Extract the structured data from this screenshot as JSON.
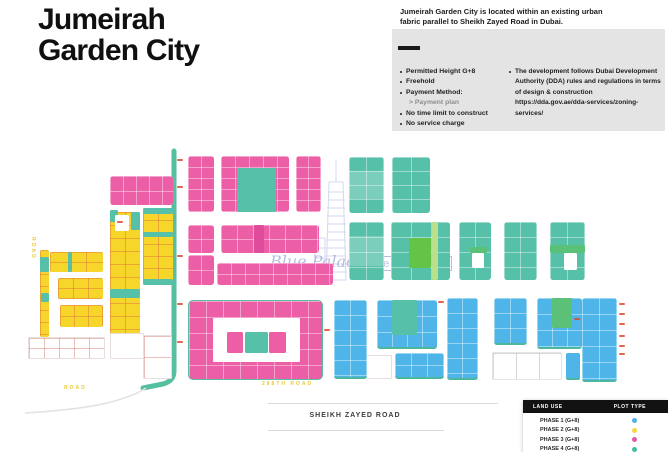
{
  "header": {
    "title_line1": "Jumeirah",
    "title_line2": "Garden City",
    "intro": "Jumeirah Garden City is located within an existing urban fabric parallel to Sheikh Zayed Road in Dubai."
  },
  "info_box": {
    "left_bullets": [
      {
        "text": "Permitted Height G+8"
      },
      {
        "text": "Freehold"
      },
      {
        "text": "Payment Method:"
      },
      {
        "text": "> Payment plan"
      },
      {
        "text": "No time limit to construct"
      },
      {
        "text": "No service charge"
      }
    ],
    "right_lines": [
      "The development follows Dubai Development",
      "Authority (DDA) rules and regulations in terms",
      "of design & construction",
      "https://dda.gov.ae/dda-services/zoning-services/"
    ]
  },
  "road": {
    "label": "SHEIKH ZAYED ROAD"
  },
  "watermark": {
    "script": "Blue Palace",
    "boxed": "Real Estate"
  },
  "legend": {
    "header_left": "LAND USE",
    "header_right": "PLOT TYPE",
    "rows": [
      {
        "label": "PHASE 1 (G+8)",
        "dot": "#4FB0E8",
        "dot_style": "background:#4FB0E8"
      },
      {
        "label": "PHASE 2 (G+8)",
        "dot": "#F7D643",
        "dot_style": "background:#F7D643"
      },
      {
        "label": "PHASE 3 (G+8)",
        "dot": "#DE5BA7",
        "dot_style": "background:#DE5BA7"
      },
      {
        "label": "PHASE 4 (G+8)",
        "dot": "#3FBF9F",
        "dot_style": "background:#3FBF9F"
      }
    ]
  },
  "colors": {
    "phase1": "#4FB5E9",
    "phase2": "#F7D62B",
    "phase3": "#EC5FA6",
    "phase4": "#57C0A9",
    "green": "#64C447",
    "green2": "#5BC178",
    "lightgreen": "#B9E08A",
    "white": "#FFFFFF",
    "road_teal": "#55BFA0",
    "tick_red": "#E0492E",
    "watermark": "#A9B2DC"
  },
  "map": {
    "blocks": [
      {
        "x": 110,
        "y": 176,
        "w": 63,
        "h": 29,
        "c": "phase3",
        "cs": [
          13,
          15
        ],
        "r": 3
      },
      {
        "x": 188,
        "y": 156,
        "w": 26,
        "h": 56,
        "c": "phase3",
        "cs": [
          13,
          11
        ],
        "r": 3
      },
      {
        "x": 221,
        "y": 156,
        "w": 68,
        "h": 56,
        "c": "phase3",
        "cs": [
          14,
          11
        ],
        "r": 3
      },
      {
        "x": 237,
        "y": 168,
        "w": 39,
        "h": 44,
        "c": "phase4",
        "r": 2
      },
      {
        "x": 296,
        "y": 156,
        "w": 25,
        "h": 56,
        "c": "phase3",
        "cs": [
          12,
          11
        ],
        "r": 3
      },
      {
        "x": 188,
        "y": 225,
        "w": 26,
        "h": 28,
        "c": "phase3",
        "cs": [
          13,
          14
        ],
        "r": 3
      },
      {
        "x": 221,
        "y": 225,
        "w": 98,
        "h": 28,
        "c": "phase3",
        "cs": [
          16,
          14
        ],
        "r": 3
      },
      {
        "x": 254,
        "y": 225,
        "w": 10,
        "h": 28,
        "c": "#E04C9C"
      },
      {
        "x": 188,
        "y": 255,
        "w": 26,
        "h": 30,
        "c": "phase3",
        "cs": [
          13,
          15
        ],
        "r": 3
      },
      {
        "x": 217,
        "y": 263,
        "w": 116,
        "h": 22,
        "c": "phase3",
        "cs": [
          14,
          11
        ],
        "r": 3
      },
      {
        "x": 188,
        "y": 300,
        "w": 133,
        "h": 78,
        "c": "phase3",
        "cs": [
          17,
          16
        ],
        "bd": "1.5px solid #55BFA0",
        "r": 5
      },
      {
        "x": 213,
        "y": 318,
        "w": 87,
        "h": 44,
        "c": "white"
      },
      {
        "x": 227,
        "y": 332,
        "w": 16,
        "h": 21,
        "c": "phase3"
      },
      {
        "x": 245,
        "y": 332,
        "w": 23,
        "h": 21,
        "c": "phase4"
      },
      {
        "x": 269,
        "y": 332,
        "w": 17,
        "h": 21,
        "c": "phase3"
      },
      {
        "x": 40,
        "y": 250,
        "w": 9,
        "h": 87,
        "c": "phase2",
        "cs": [
          9,
          12
        ],
        "r": 2
      },
      {
        "x": 40,
        "y": 257,
        "w": 9,
        "h": 15,
        "c": "phase4"
      },
      {
        "x": 41,
        "y": 293,
        "w": 8,
        "h": 9,
        "c": "phase4"
      },
      {
        "x": 50,
        "y": 252,
        "w": 53,
        "h": 20,
        "c": "phase2",
        "cs": [
          18,
          10
        ],
        "r": 2
      },
      {
        "x": 68,
        "y": 252,
        "w": 4,
        "h": 20,
        "c": "phase4"
      },
      {
        "x": 58,
        "y": 278,
        "w": 45,
        "h": 21,
        "c": "phase2",
        "cs": [
          15,
          10
        ],
        "r": 2
      },
      {
        "x": 60,
        "y": 305,
        "w": 43,
        "h": 22,
        "c": "phase2",
        "cs": [
          14,
          11
        ],
        "r": 2
      },
      {
        "x": 110,
        "y": 212,
        "w": 30,
        "h": 123,
        "c": "phase2",
        "cs": [
          15,
          13
        ],
        "r": 3
      },
      {
        "x": 110,
        "y": 210,
        "w": 8,
        "h": 12,
        "c": "phase4"
      },
      {
        "x": 131,
        "y": 212,
        "w": 9,
        "h": 18,
        "c": "phase4"
      },
      {
        "x": 115,
        "y": 215,
        "w": 14,
        "h": 16,
        "c": "white"
      },
      {
        "x": 110,
        "y": 289,
        "w": 30,
        "h": 9,
        "c": "phase4"
      },
      {
        "x": 143,
        "y": 208,
        "w": 30,
        "h": 77,
        "c": "phase2",
        "cs": [
          15,
          12
        ],
        "r": 3
      },
      {
        "x": 143,
        "y": 208,
        "w": 30,
        "h": 6,
        "c": "phase4"
      },
      {
        "x": 143,
        "y": 232,
        "w": 30,
        "h": 5,
        "c": "phase4"
      },
      {
        "x": 143,
        "y": 279,
        "w": 30,
        "h": 6,
        "c": "phase4"
      },
      {
        "x": 28,
        "y": 337,
        "w": 75,
        "h": 20,
        "c": "white",
        "cs": [
          15,
          10
        ],
        "lc": "rgba(214,130,120,.5)",
        "bd": "1px solid #E8DEDE"
      },
      {
        "x": 110,
        "y": 333,
        "w": 32,
        "h": 24,
        "c": "white",
        "bd": "1px solid #E8DEDE"
      },
      {
        "x": 143,
        "y": 335,
        "w": 27,
        "h": 42,
        "c": "white",
        "cs": [
          27,
          21
        ],
        "lc": "rgba(214,130,120,.5)",
        "bd": "1px solid #E8DEDE"
      },
      {
        "x": 366,
        "y": 355,
        "w": 24,
        "h": 22,
        "c": "white",
        "bd": "1px solid #E8DEDE"
      },
      {
        "x": 492,
        "y": 352,
        "w": 68,
        "h": 26,
        "c": "white",
        "cs": [
          23,
          26
        ],
        "lc": "rgba(190,190,190,.6)",
        "bd": "1px solid #E5E5E5"
      },
      {
        "x": 349,
        "y": 157,
        "w": 35,
        "h": 56,
        "c": "phase4",
        "cs": [
          17,
          14
        ],
        "r": 3
      },
      {
        "x": 349,
        "y": 171,
        "w": 35,
        "h": 28,
        "c": "rgba(255,255,255,.22)"
      },
      {
        "x": 392,
        "y": 157,
        "w": 38,
        "h": 56,
        "c": "phase4",
        "cs": [
          19,
          14
        ],
        "r": 3
      },
      {
        "x": 349,
        "y": 222,
        "w": 35,
        "h": 58,
        "c": "phase4",
        "cs": [
          17,
          15
        ],
        "r": 3
      },
      {
        "x": 349,
        "y": 236,
        "w": 35,
        "h": 30,
        "c": "rgba(255,255,255,.22)"
      },
      {
        "x": 391,
        "y": 222,
        "w": 59,
        "h": 58,
        "c": "phase4",
        "cs": [
          20,
          15
        ],
        "r": 3
      },
      {
        "x": 409,
        "y": 238,
        "w": 22,
        "h": 30,
        "c": "green"
      },
      {
        "x": 432,
        "y": 222,
        "w": 6,
        "h": 58,
        "c": "lightgreen"
      },
      {
        "x": 459,
        "y": 222,
        "w": 32,
        "h": 58,
        "c": "phase4",
        "cs": [
          16,
          15
        ],
        "r": 3
      },
      {
        "x": 470,
        "y": 247,
        "w": 17,
        "h": 6,
        "c": "green2"
      },
      {
        "x": 472,
        "y": 253,
        "w": 12,
        "h": 15,
        "c": "white"
      },
      {
        "x": 504,
        "y": 222,
        "w": 33,
        "h": 58,
        "c": "phase4",
        "cs": [
          16,
          15
        ],
        "r": 3
      },
      {
        "x": 550,
        "y": 222,
        "w": 35,
        "h": 58,
        "c": "phase4",
        "cs": [
          17,
          15
        ],
        "r": 3
      },
      {
        "x": 550,
        "y": 245,
        "w": 35,
        "h": 8,
        "c": "green2"
      },
      {
        "x": 564,
        "y": 253,
        "w": 13,
        "h": 17,
        "c": "white"
      },
      {
        "x": 334,
        "y": 300,
        "w": 33,
        "h": 77,
        "c": "phase1",
        "cs": [
          16,
          15
        ],
        "bb": 1,
        "r": 3
      },
      {
        "x": 377,
        "y": 300,
        "w": 60,
        "h": 47,
        "c": "phase1",
        "cs": [
          15,
          16
        ],
        "bb": 1,
        "r": 3
      },
      {
        "x": 392,
        "y": 300,
        "w": 25,
        "h": 35,
        "c": "phase4"
      },
      {
        "x": 395,
        "y": 353,
        "w": 49,
        "h": 24,
        "c": "phase1",
        "cs": [
          16,
          12
        ],
        "bb": 1,
        "r": 3
      },
      {
        "x": 447,
        "y": 298,
        "w": 31,
        "h": 80,
        "c": "phase1",
        "cs": [
          15,
          15
        ],
        "bb": 1,
        "r": 3
      },
      {
        "x": 494,
        "y": 298,
        "w": 33,
        "h": 45,
        "c": "phase1",
        "cs": [
          16,
          15
        ],
        "bb": 1,
        "r": 3
      },
      {
        "x": 537,
        "y": 298,
        "w": 45,
        "h": 49,
        "c": "phase1",
        "cs": [
          15,
          16
        ],
        "bb": 1,
        "r": 3
      },
      {
        "x": 552,
        "y": 298,
        "w": 20,
        "h": 30,
        "c": "green2"
      },
      {
        "x": 582,
        "y": 298,
        "w": 35,
        "h": 82,
        "c": "phase1",
        "cs": [
          17,
          16
        ],
        "bb": 1,
        "r": 3
      },
      {
        "x": 566,
        "y": 353,
        "w": 14,
        "h": 25,
        "c": "phase1",
        "bb": 1,
        "r": 2
      }
    ],
    "ticks": [
      [
        177,
        159
      ],
      [
        177,
        186
      ],
      [
        177,
        255
      ],
      [
        177,
        303
      ],
      [
        177,
        341
      ],
      [
        117,
        221
      ],
      [
        324,
        329
      ],
      [
        574,
        318
      ],
      [
        438,
        301
      ],
      [
        619,
        303
      ],
      [
        619,
        313
      ],
      [
        619,
        323
      ],
      [
        619,
        335
      ],
      [
        619,
        345
      ],
      [
        619,
        353
      ]
    ],
    "road_labels": [
      {
        "t": "288TH ROAD",
        "x": 262,
        "y": 381,
        "v": 0
      },
      {
        "t": "ROAD",
        "x": 30,
        "y": 237,
        "v": 1
      },
      {
        "t": "ROAD",
        "x": 64,
        "y": 385,
        "v": 0
      }
    ]
  }
}
